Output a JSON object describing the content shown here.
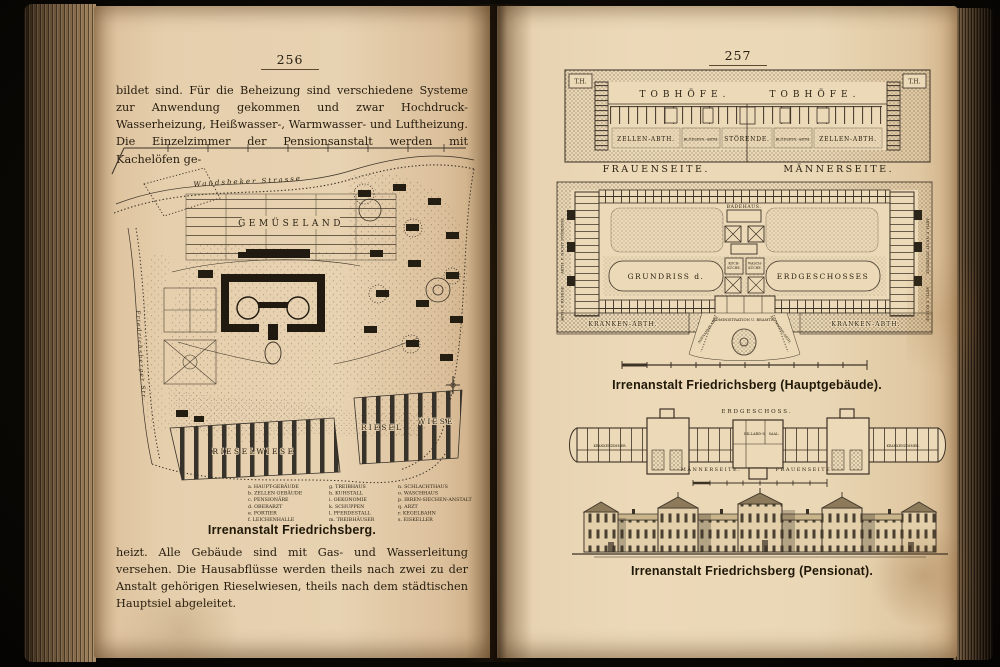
{
  "page_left": {
    "page_number": "256",
    "top_paragraph": "bildet sind. Für die Beheizung sind verschiedene Systeme zur Anwendung gekommen und zwar Hochdruck-Wasserheizung, Heißwasser-, Warmwasser- und Luftheizung. Die Einzelzimmer der Pensionsanstalt werden mit Kachelöfen ge-",
    "caption": "Irrenanstalt Friedrichsberg.",
    "bottom_paragraph": "heizt. Alle Gebäude sind mit Gas- und Wasserleitung versehen. Die Hausabflüsse werden theils nach zwei zu der Anstalt gehörigen Rieselwiesen, theils nach dem städtischen Hauptsiel abgeleitet.",
    "map": {
      "street": "Wandsbeker Strasse",
      "left_road": "Friedrichsberger Str.",
      "gemueseland": "GEMÜSELAND",
      "riesel_left": "RIESELWIESE",
      "riesel_right_a": "RIESEL",
      "riesel_right_b": "WIESE",
      "legend": {
        "col1": [
          "a. HAUPT-GEBÄUDE",
          "b. ZELLEN GEBÄUDE",
          "c. PENSIONÄRE",
          "d. OBERARZT",
          "e. PORTIER",
          "f. LEICHENHALLE"
        ],
        "col2": [
          "g. TREIBHAUS",
          "h. KUHSTALL",
          "i. OEKONOMIE",
          "k. SCHUPPEN",
          "l. PFERDESTALL",
          "m. TREIBHÄUSER"
        ],
        "col3": [
          "n. SCHLACHTHAUS",
          "o. WASCHHAUS",
          "p. IRREN-SIECHEN-ANSTALT",
          "q. ARZT",
          "r. KEGELBAHN",
          "s. EISKELLER"
        ]
      }
    }
  },
  "page_right": {
    "page_number": "257",
    "cell_plan": {
      "th_left": "T.H.",
      "th_right": "T.H.",
      "tobhoefe_left": "TOBHÖFE.",
      "tobhoefe_right": "TOBHÖFE.",
      "zellen_left": "ZELLEN-ABTH.",
      "zellen_right": "ZELLEN-ABTH.",
      "bloeds_left": "BLÖDSINN.-ABTH.",
      "bloeds_right": "BLÖDSINN.-ABTH.",
      "stoerende": "STÖRENDE."
    },
    "seite_left": "FRAUENSEITE.",
    "seite_right": "MÄNNERSEITE.",
    "main_plan": {
      "badehaus": "BADEHAUS.",
      "grundriss": "GRUNDRISS d.",
      "erdgeschosses": "ERDGESCHOSSES",
      "koch_a": "KOCH-",
      "koch_b": "KÜCHE.",
      "wasch_a": "WASCH-",
      "wasch_b": "KÜCHE.",
      "side_left_top": "ABTH. F. NICHT STÖRENDE",
      "side_left_bottom": "ABTH. F. RUHIGE",
      "side_right_top": "ABTH. F. NICHT STÖRENDE",
      "side_right_bottom": "ABTH. F. RUHIGE",
      "administration": "ADMINISTRATION U. BEAMTE.",
      "aufnahme_left": "AUFNAHME-ABTH.",
      "aufnahme_right": "AUFNAHME-ABTH.",
      "kranken_left": "KRANKEN-ABTH.",
      "kranken_right": "KRANKEN-ABTH."
    },
    "caption_main": "Irrenanstalt Friedrichsberg (Hauptgebäude).",
    "pension_plan": {
      "erdgeschoss": "ERDGESCHOSS.",
      "billard": "BILLARD-S.",
      "saal": "SAAL.",
      "kranken_left": "KRANKENZIMMER.",
      "kranken_right": "KRANKENZIMMER.",
      "maennerseite": "MÄNNERSEITE.",
      "frauenseite": "FRAUENSEITE."
    },
    "caption_pension": "Irrenanstalt Friedrichsberg (Pensionat)."
  },
  "colors": {
    "paper": "#e6cfad",
    "ink": "#2b2314",
    "background": "#0a0805"
  }
}
